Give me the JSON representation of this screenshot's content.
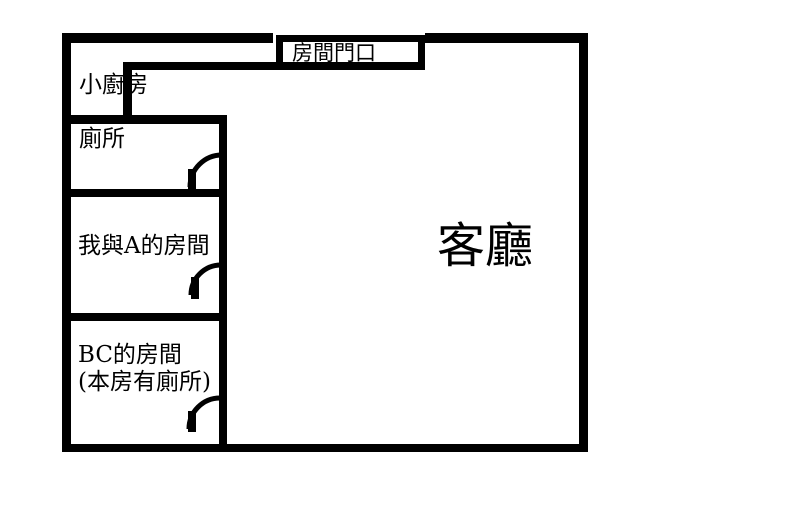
{
  "colors": {
    "wall": "#000000",
    "background": "#ffffff",
    "text": "#000000"
  },
  "entrance": {
    "label": "房間門口"
  },
  "rooms": [
    {
      "id": "kitchen",
      "label": "小廚房"
    },
    {
      "id": "toilet",
      "label": "廁所"
    },
    {
      "id": "room-me-a",
      "label": "我與A的房間"
    },
    {
      "id": "room-bc",
      "label": "BC的房間",
      "note": "(本房有廁所)"
    },
    {
      "id": "living-room",
      "label": "客廳"
    }
  ]
}
